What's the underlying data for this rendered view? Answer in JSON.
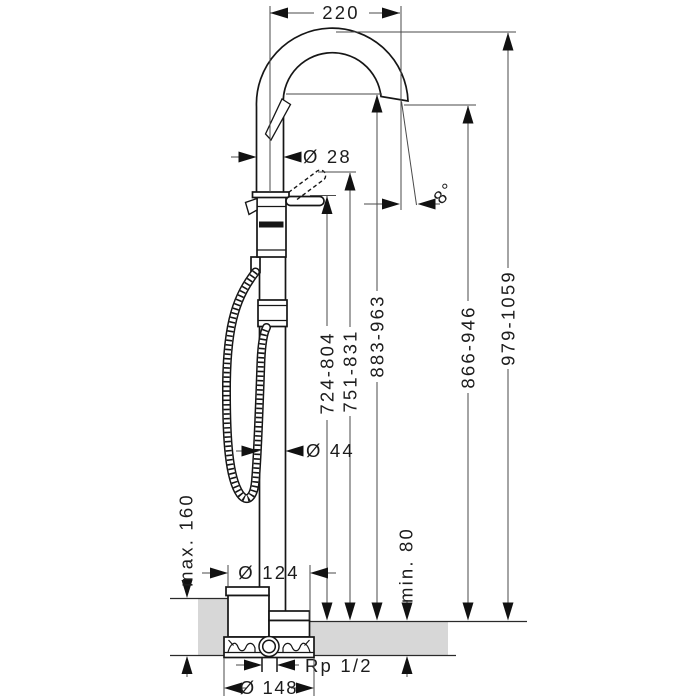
{
  "drawing": {
    "title": "freestanding-bath-mixer-dimension-drawing",
    "dimensions": {
      "spout_reach": "220",
      "spout_pipe_diameter": "Ø 28",
      "spout_angle": "8°",
      "handle_height_range": "724-804",
      "handle_raised_range": "751-831",
      "spout_underside_range": "883-963",
      "outlet_height_range": "866-946",
      "total_height_range": "979-1059",
      "riser_diameter": "Ø 44",
      "floor_buildup_max": "max. 160",
      "floor_buildup_min": "min. 80",
      "escutcheon_diameter": "Ø 124",
      "pipe_connection": "Rp 1/2",
      "basic_set_diameter": "Ø 148"
    },
    "colors": {
      "line": "#161616",
      "dimension_line": "#4a4a4a",
      "floor_fill": "#d7d7d7"
    }
  }
}
